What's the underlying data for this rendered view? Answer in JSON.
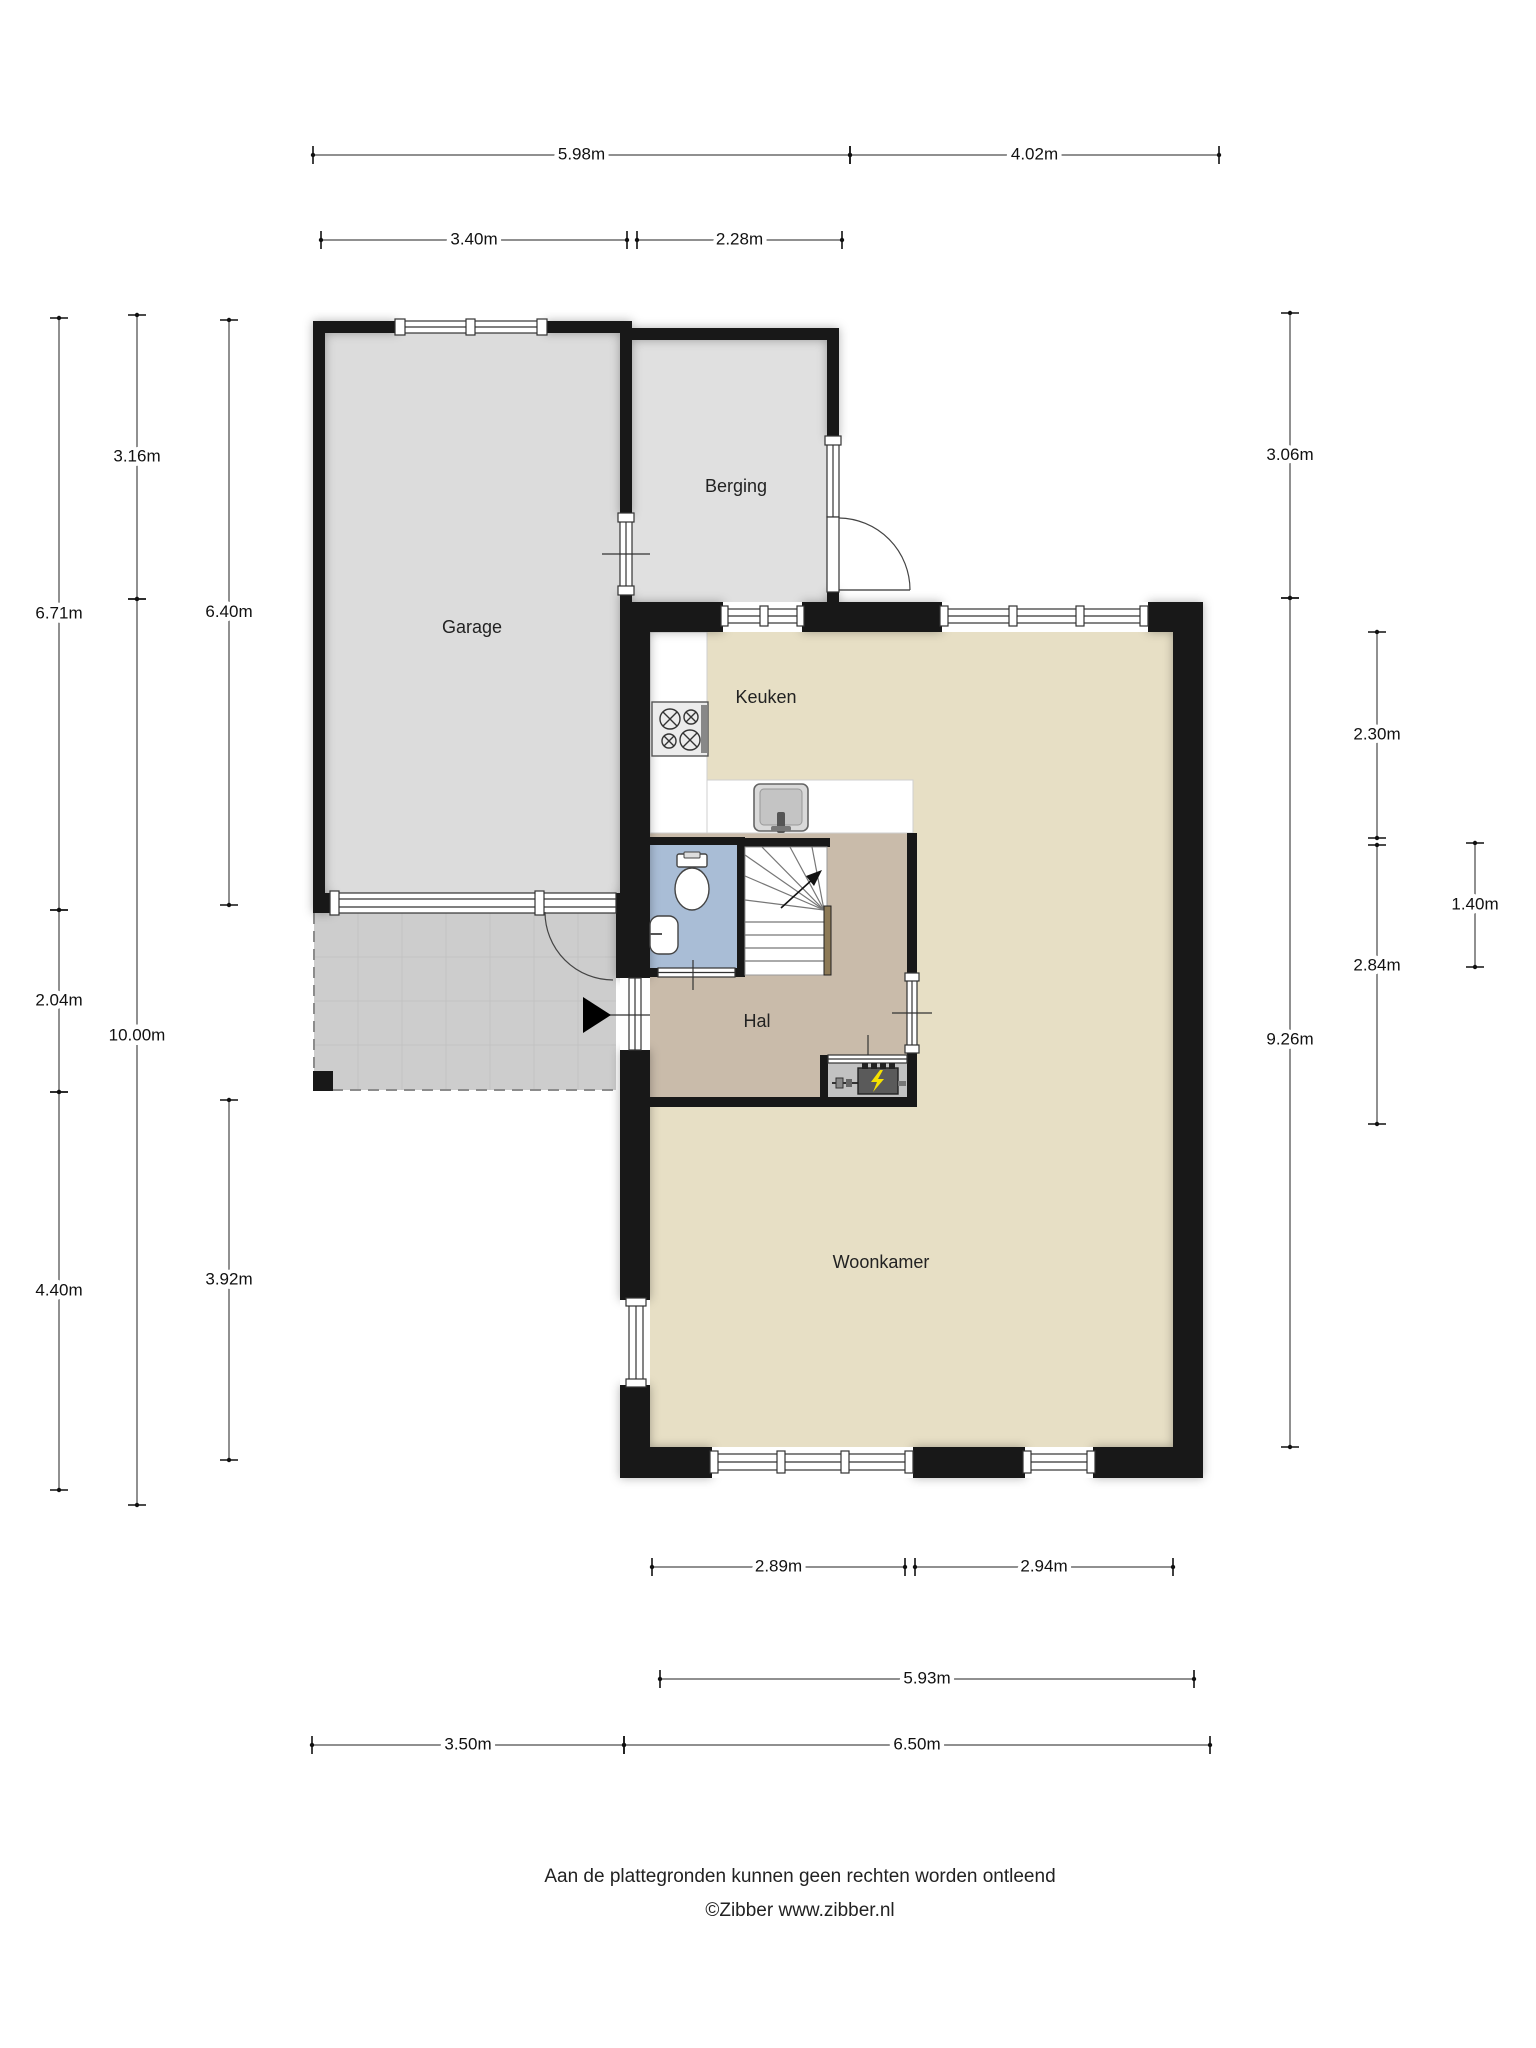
{
  "rooms": [
    {
      "id": "garage",
      "label": "Garage",
      "x": 472,
      "y": 628
    },
    {
      "id": "berging",
      "label": "Berging",
      "x": 736,
      "y": 487
    },
    {
      "id": "keuken",
      "label": "Keuken",
      "x": 766,
      "y": 698
    },
    {
      "id": "hal",
      "label": "Hal",
      "x": 757,
      "y": 1022
    },
    {
      "id": "woonkamer",
      "label": "Woonkamer",
      "x": 881,
      "y": 1263
    }
  ],
  "dimensions": {
    "horizontal": [
      {
        "label": "5.98m",
        "y": 155,
        "x1": 313,
        "x2": 850
      },
      {
        "label": "4.02m",
        "y": 155,
        "x1": 850,
        "x2": 1219
      },
      {
        "label": "3.40m",
        "y": 240,
        "x1": 321,
        "x2": 627
      },
      {
        "label": "2.28m",
        "y": 240,
        "x1": 637,
        "x2": 842
      },
      {
        "label": "2.89m",
        "y": 1567,
        "x1": 652,
        "x2": 905
      },
      {
        "label": "2.94m",
        "y": 1567,
        "x1": 915,
        "x2": 1173
      },
      {
        "label": "5.93m",
        "y": 1679,
        "x1": 660,
        "x2": 1194
      },
      {
        "label": "3.50m",
        "y": 1745,
        "x1": 312,
        "x2": 624
      },
      {
        "label": "6.50m",
        "y": 1745,
        "x1": 624,
        "x2": 1210
      }
    ],
    "vertical": [
      {
        "label": "6.71m",
        "x": 59,
        "y1": 318,
        "y2": 910
      },
      {
        "label": "2.04m",
        "x": 59,
        "y1": 910,
        "y2": 1092
      },
      {
        "label": "4.40m",
        "x": 59,
        "y1": 1092,
        "y2": 1490
      },
      {
        "label": "3.16m",
        "x": 137,
        "y1": 315,
        "y2": 599
      },
      {
        "label": "10.00m",
        "x": 137,
        "y1": 599,
        "y2": 1505,
        "ly": 1036
      },
      {
        "label": "6.40m",
        "x": 229,
        "y1": 320,
        "y2": 905
      },
      {
        "label": "3.92m",
        "x": 229,
        "y1": 1100,
        "y2": 1460
      },
      {
        "label": "3.06m",
        "x": 1290,
        "y1": 313,
        "y2": 598
      },
      {
        "label": "9.26m",
        "x": 1290,
        "y1": 598,
        "y2": 1447,
        "ly": 1040
      },
      {
        "label": "2.30m",
        "x": 1377,
        "y1": 632,
        "y2": 838
      },
      {
        "label": "2.84m",
        "x": 1377,
        "y1": 845,
        "y2": 1124,
        "ly": 966
      },
      {
        "label": "1.40m",
        "x": 1475,
        "y1": 843,
        "y2": 967
      }
    ]
  },
  "footer": {
    "line1": "Aan de plattegronden kunnen geen rechten worden ontleend",
    "line2": "©Zibber www.zibber.nl"
  },
  "colors": {
    "wall": "#181818",
    "garage-floor": "#dcdcdc",
    "berging-floor": "#e0e0e0",
    "living-floor": "#e7dfc5",
    "hal-floor": "#c9bbaa",
    "toilet-floor": "#a9bdd6",
    "patio": "#cdcdcd",
    "patio-grid": "#c2c2c2",
    "meterkast": "#c2c2c2",
    "counter": "#ffffff",
    "handrail": "#8d7a57",
    "bolt": "#f5e100"
  }
}
